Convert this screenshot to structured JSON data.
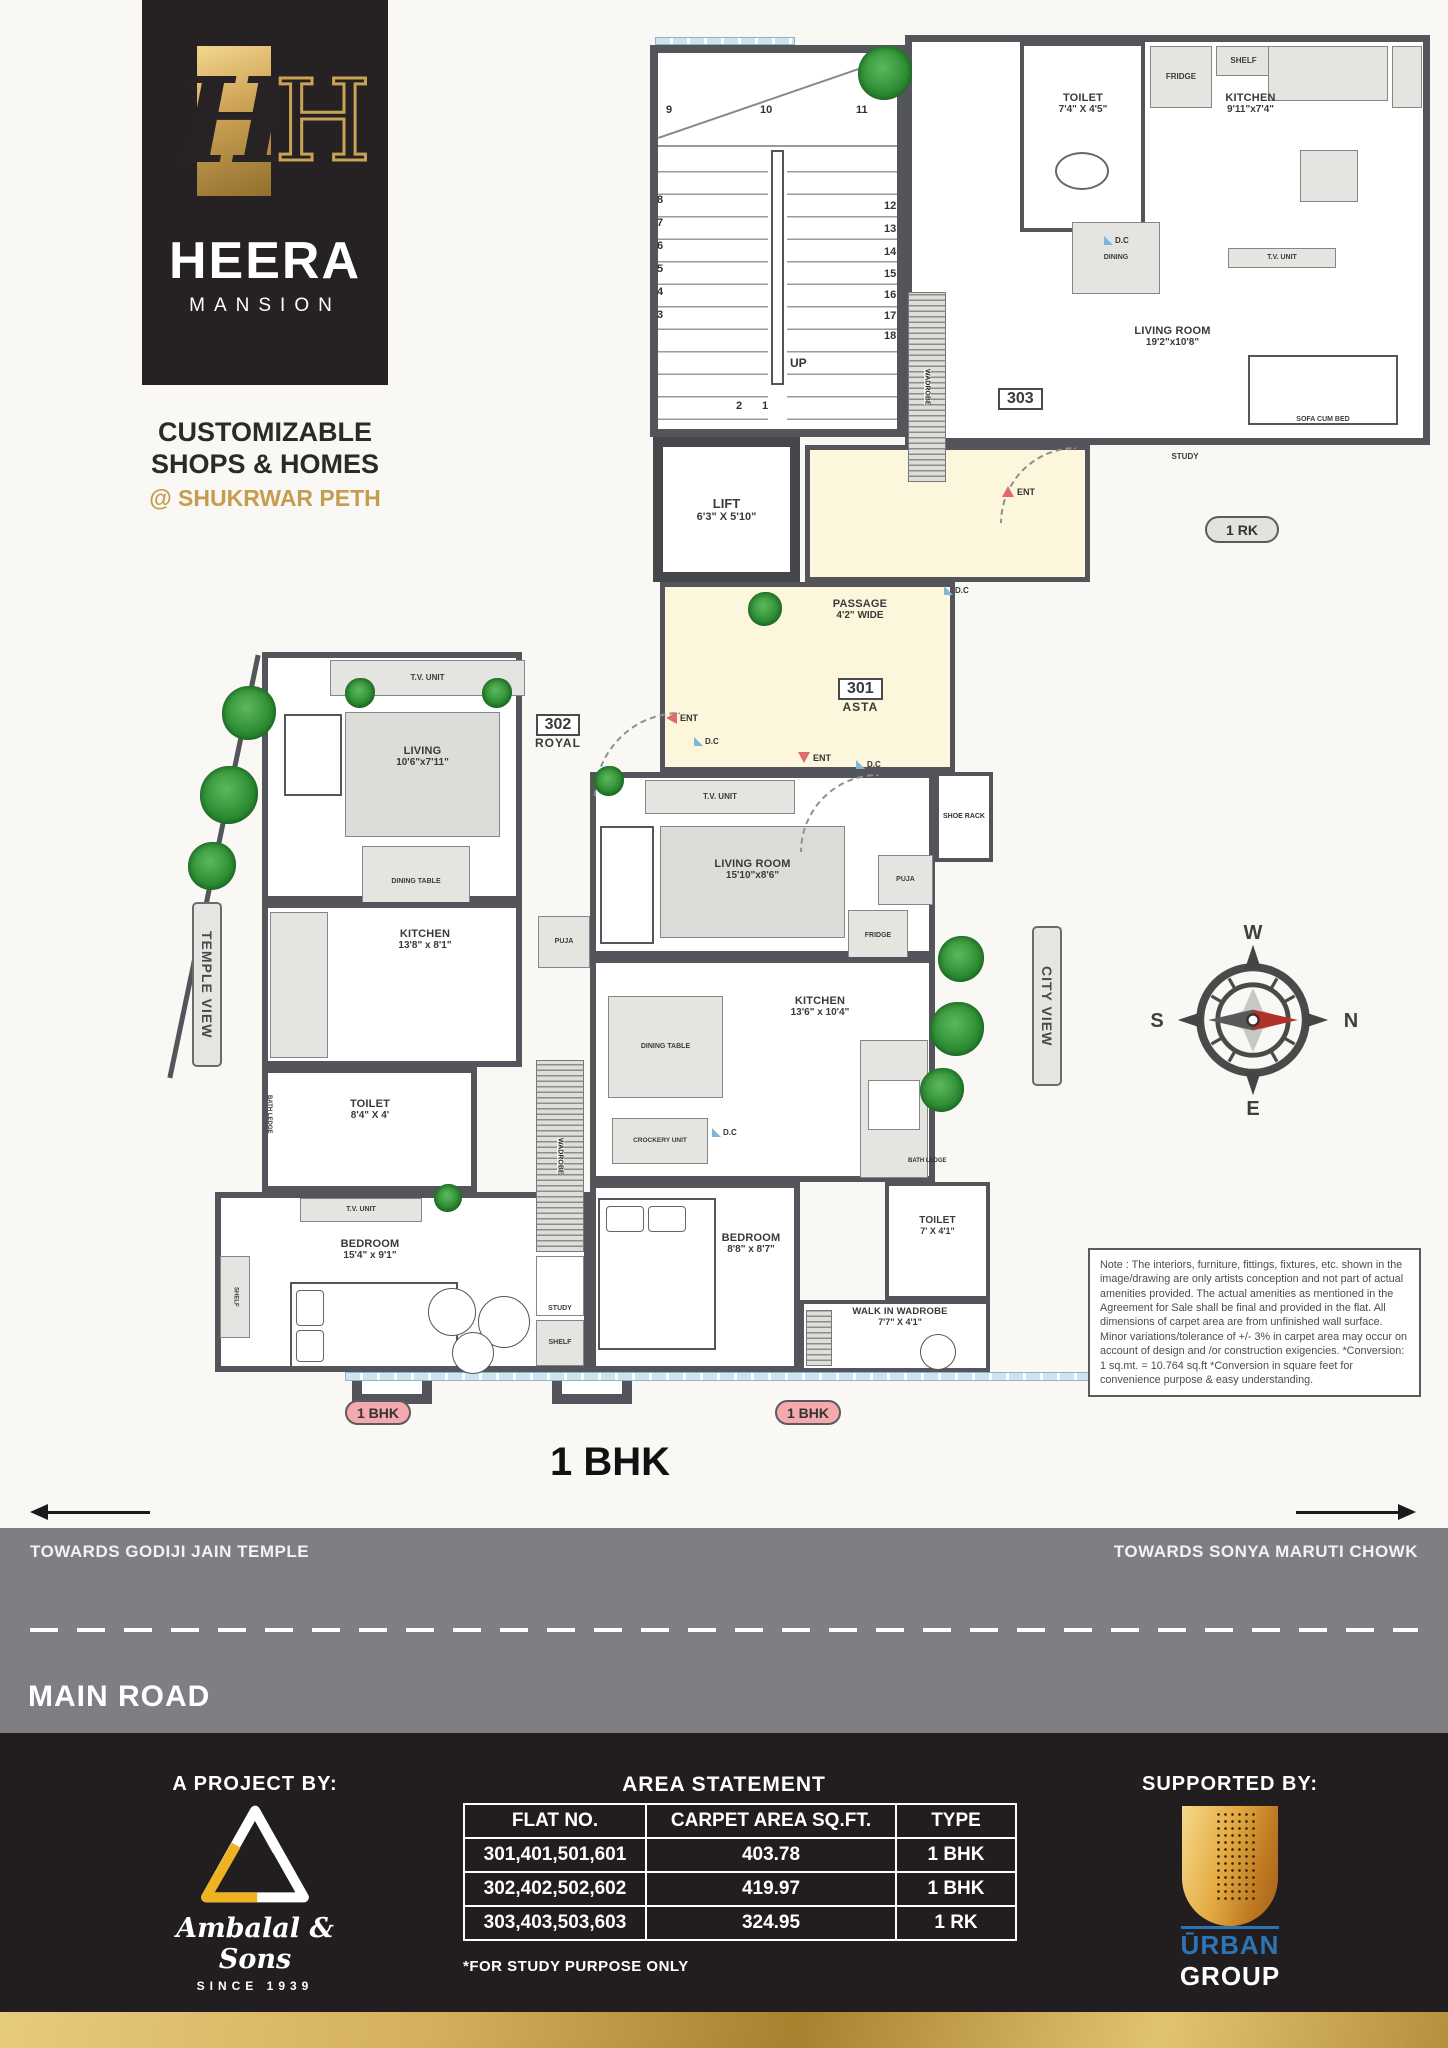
{
  "brand": {
    "monogram": "H",
    "name": "HEERA",
    "subname": "MANSION",
    "tagline1": "CUSTOMIZABLE",
    "tagline2": "SHOPS & HOMES",
    "tagline3": "@ SHUKRWAR PETH",
    "gold": "#c9a254",
    "dark": "#262223"
  },
  "plan": {
    "title": "1 BHK",
    "stairs": {
      "up": "UP",
      "numbers": [
        "1",
        "2",
        "3",
        "4",
        "5",
        "6",
        "7",
        "8",
        "9",
        "10",
        "11",
        "12",
        "13",
        "14",
        "15",
        "16",
        "17",
        "18"
      ]
    },
    "lift": {
      "name": "LIFT",
      "dim": "6'3\" X 5'10\""
    },
    "passage": {
      "name": "PASSAGE",
      "dim": "4'2\" WIDE"
    },
    "ent": "ENT",
    "dc": "D.C",
    "unit303": {
      "id": "303",
      "badge": "1 RK",
      "fridge": "FRIDGE",
      "shelf": "SHELF",
      "toilet": "TOILET",
      "toilet_dim": "7'4\" X 4'5\"",
      "kitchen": "KITCHEN",
      "kitchen_dim": "9'11\"x7'4\"",
      "dining": "DINING",
      "tv": "T.V. UNIT",
      "living": "LIVING ROOM",
      "living_dim": "19'2\"x10'8\"",
      "sofa": "SOFA CUM BED",
      "study": "STUDY",
      "wadrobe": "WADROBE"
    },
    "unit302": {
      "id": "302",
      "name": "ROYAL",
      "badge": "1 BHK",
      "tv": "T.V. UNIT",
      "living": "LIVING",
      "living_dim": "10'6\"x7'11\"",
      "dining": "DINING TABLE",
      "kitchen": "KITCHEN",
      "kitchen_dim": "13'8\" x 8'1\"",
      "puja": "PUJA",
      "toilet": "TOILET",
      "toilet_dim": "8'4\" X 4'",
      "bath_ledge": "BATH LEDGE",
      "tv2": "T.V. UNIT",
      "bedroom": "BEDROOM",
      "bedroom_dim": "15'4\" x 9'1\"",
      "shelf_side": "SHELF",
      "wadrobe": "WADROBE",
      "study": "STUDY",
      "shelf": "SHELF"
    },
    "unit301": {
      "id": "301",
      "name": "ASTA",
      "badge": "1 BHK",
      "tv": "T.V. UNIT",
      "living": "LIVING ROOM",
      "living_dim": "15'10\"x8'6\"",
      "shoe_rack": "SHOE RACK",
      "puja": "PUJA",
      "fridge": "FRIDGE",
      "dining": "DINING TABLE",
      "kitchen": "KITCHEN",
      "kitchen_dim": "13'6\" x 10'4\"",
      "crockery": "CROCKERY UNIT",
      "bedroom": "BEDROOM",
      "bedroom_dim": "8'8\" x 8'7\"",
      "toilet": "TOILET",
      "toilet_dim": "7' X 4'1\"",
      "bath_ledge": "BATH LEDGE",
      "walkin": "WALK IN WADROBE",
      "walkin_dim": "7'7\" X 4'1\"",
      "wadrobe": "WADROBE",
      "study": "STUDY",
      "shelf": "SHELF"
    },
    "views": {
      "left": "TEMPLE VIEW",
      "right": "CITY VIEW"
    },
    "compass": {
      "n": "N",
      "s": "S",
      "e": "E",
      "w": "W"
    },
    "note": "Note : The interiors, furniture, fittings, fixtures, etc. shown in the image/drawing are only artists conception and not part of actual amenities provided. The actual amenities as mentioned in the Agreement for Sale shall be final and provided in the flat. All dimensions of carpet area are from unfinished wall surface. Minor variations/tolerance of +/- 3% in carpet area may occur on account of design and /or construction exigencies. *Conversion: 1 sq.mt. = 10.764 sq.ft *Conversion in square feet for convenience purpose & easy understanding."
  },
  "road": {
    "left": "TOWARDS GODIJI JAIN TEMPLE",
    "right": "TOWARDS SONYA MARUTI CHOWK",
    "name": "MAIN ROAD"
  },
  "footer": {
    "project_by": "A PROJECT BY:",
    "project_name": "Ambalal & Sons",
    "since": "SINCE 1939",
    "area_title": "AREA STATEMENT",
    "table": {
      "headers": [
        "FLAT NO.",
        "CARPET AREA SQ.FT.",
        "TYPE"
      ],
      "rows": [
        [
          "301,401,501,601",
          "403.78",
          "1 BHK"
        ],
        [
          "302,402,502,602",
          "419.97",
          "1 BHK"
        ],
        [
          "303,403,503,603",
          "324.95",
          "1 RK"
        ]
      ]
    },
    "footnote": "*FOR STUDY PURPOSE ONLY",
    "supported_by": "SUPPORTED BY:",
    "supporter_accent": "ŪRBAN",
    "supporter_rest": "GROUP"
  }
}
